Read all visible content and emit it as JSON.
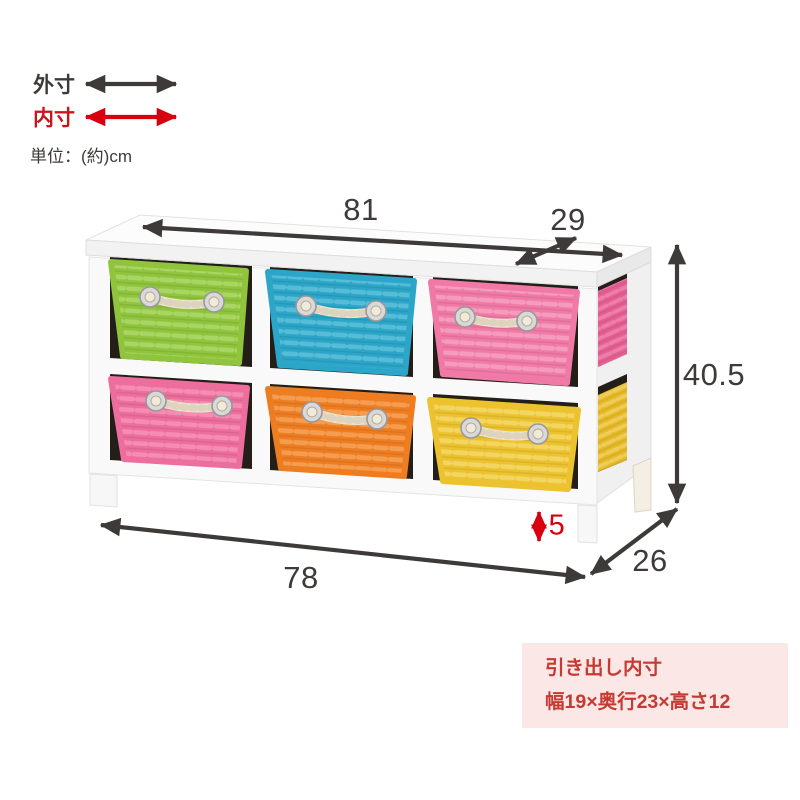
{
  "legend": {
    "outer_label": "外寸",
    "inner_label": "内寸",
    "unit_label": "単位：(約)cm"
  },
  "dimensions": {
    "top_width": "81",
    "top_depth": "29",
    "height": "40.5",
    "bottom_width": "78",
    "bottom_depth": "26",
    "leg_height": "5"
  },
  "info_box": {
    "line1": "引き出し内寸",
    "line2": "幅19×奥行23×高さ12",
    "bg_color": "#fbe7e5",
    "text_color": "#c53a32"
  },
  "colors": {
    "arrow_dark": "#3d3a39",
    "arrow_red": "#d7000f",
    "legend_inner_red": "#c8161d",
    "label_dark": "#3d3a39",
    "frame_white": "#f9f9f9",
    "slab_white": "#fcfcfc",
    "cell_dark": "#241e18",
    "rope": "#ebe4d3"
  },
  "baskets": {
    "top_row": [
      {
        "name": "green",
        "base": "#8fc43c",
        "stripe": "#abd767"
      },
      {
        "name": "blue",
        "base": "#2ba5c8",
        "stripe": "#5cbfd9"
      },
      {
        "name": "pink",
        "base": "#f07aa5",
        "stripe": "#f69fbf"
      }
    ],
    "bottom_row": [
      {
        "name": "pink",
        "base": "#ed6d9c",
        "stripe": "#f590b4"
      },
      {
        "name": "orange",
        "base": "#ee7d22",
        "stripe": "#f6a155"
      },
      {
        "name": "yellow",
        "base": "#ecc22f",
        "stripe": "#f4d767"
      }
    ],
    "side": [
      {
        "name": "pink",
        "base": "#e55f93",
        "stripe": "#ef82ac"
      },
      {
        "name": "yellow",
        "base": "#e6ba27",
        "stripe": "#f0cf5e"
      }
    ]
  }
}
